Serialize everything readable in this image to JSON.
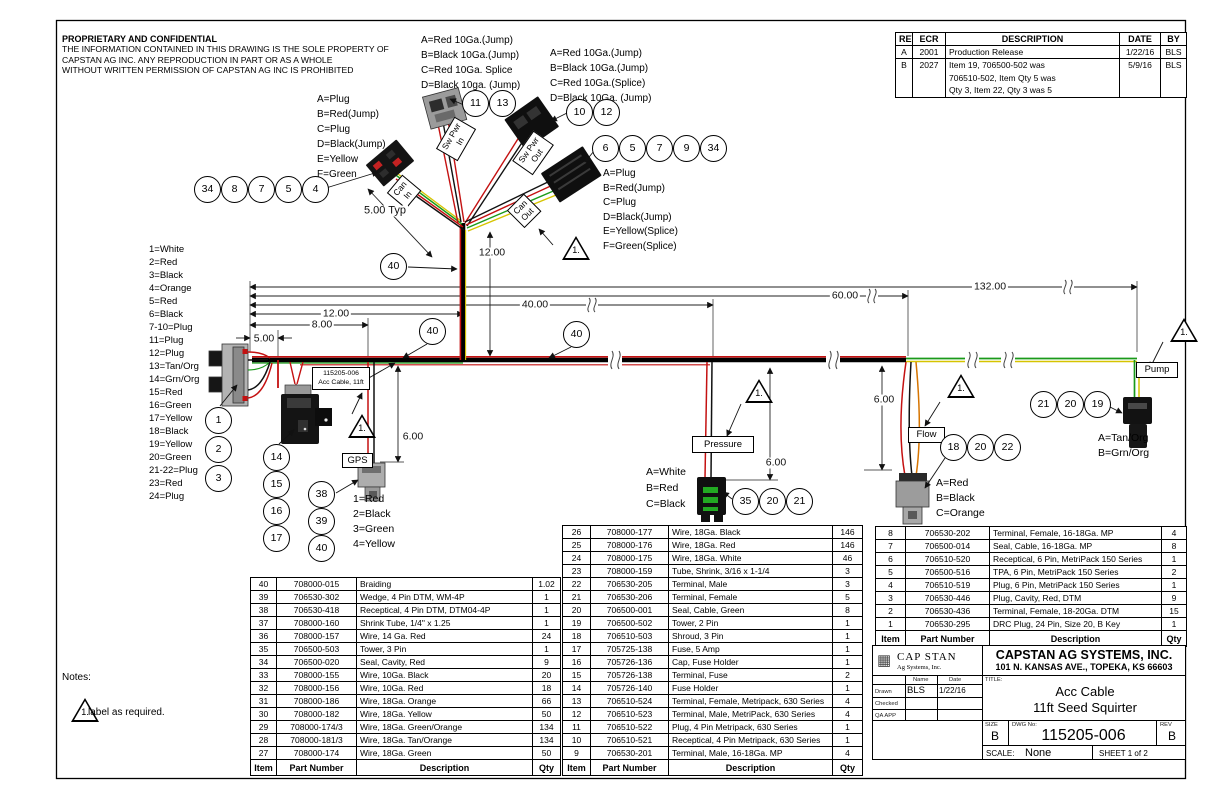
{
  "notice": {
    "title": "PROPRIETARY AND CONFIDENTIAL",
    "line1": "THE INFORMATION CONTAINED IN THIS DRAWING IS THE SOLE PROPERTY OF",
    "line2": "CAPSTAN AG INC. ANY REPRODUCTION IN PART OR AS A WHOLE",
    "line3": "WITHOUT WRITTEN PERMISSION OF CAPSTAN AG INC IS PROHIBITED"
  },
  "revision_table": {
    "headers": [
      "REV",
      "ECR",
      "DESCRIPTION",
      "DATE",
      "BY"
    ],
    "rows": [
      [
        "A",
        "2001",
        "Production Release",
        "1/22/16",
        "BLS"
      ],
      [
        "B",
        "2027",
        "Item 19, 706500-502 was\n706510-502, Item Qty 5 was\nQty 3, Item 22, Qty 3 was 5",
        "5/9/16",
        "BLS"
      ]
    ]
  },
  "wire_legend": [
    "1=White",
    "2=Red",
    "3=Black",
    "4=Orange",
    "5=Red",
    "6=Black",
    "7-10=Plug",
    "11=Plug",
    "12=Plug",
    "13=Tan/Org",
    "14=Grn/Org",
    "15=Red",
    "16=Green",
    "17=Yellow",
    "18=Black",
    "19=Yellow",
    "20=Green",
    "21-22=Plug",
    "23=Red",
    "24=Plug"
  ],
  "pin_groups": {
    "conn_a": [
      "A=Plug",
      "B=Red(Jump)",
      "C=Plug",
      "D=Black(Jump)",
      "E=Yellow",
      "F=Green"
    ],
    "jump_in": [
      "A=Red 10Ga.(Jump)",
      "B=Black 10Ga.(Jump)",
      "C=Red 10Ga. Splice",
      "D=Black 10ga. (Jump)"
    ],
    "jump_out": [
      "A=Red 10Ga.(Jump)",
      "B=Black 10Ga.(Jump)",
      "C=Red 10Ga.(Splice)",
      "D=Black 10Ga. (Jump)"
    ],
    "can_out": [
      "A=Plug",
      "B=Red(Jump)",
      "C=Plug",
      "D=Black(Jump)",
      "E=Yellow(Splice)",
      "F=Green(Splice)"
    ],
    "gps": [
      "1=Red",
      "2=Black",
      "3=Green",
      "4=Yellow"
    ],
    "pressure": [
      "A=White",
      "B=Red",
      "C=Black"
    ],
    "flow": [
      "A=Red",
      "B=Black",
      "C=Orange"
    ],
    "pump": [
      "A=Tan/Org",
      "B=Grn/Org"
    ]
  },
  "callouts": {
    "can_in": [
      "34",
      "8",
      "7",
      "5",
      "4"
    ],
    "sw_pwr_in": [
      "11",
      "13"
    ],
    "sw_pwr_out": [
      "10",
      "12"
    ],
    "can_out": [
      "6",
      "5",
      "7",
      "9",
      "34"
    ],
    "drc": [
      "1",
      "2",
      "3"
    ],
    "fuse": [
      "14",
      "15",
      "16",
      "17"
    ],
    "gps": [
      "38",
      "39",
      "40"
    ],
    "pressure": [
      "35",
      "20",
      "21"
    ],
    "flow": [
      "18",
      "20",
      "22"
    ],
    "pump": [
      "21",
      "20",
      "19"
    ],
    "braid": [
      "40",
      "40",
      "40"
    ]
  },
  "branch_labels": {
    "can_in": "Can\nIn",
    "sw_pwr_in": "Sw Pwr\nIn",
    "sw_pwr_out": "Sw Pwr\nOut",
    "can_out": "Can\nOut"
  },
  "device_labels": {
    "gps": "GPS",
    "pressure": "Pressure",
    "flow": "Flow",
    "pump": "Pump"
  },
  "cable_tag": {
    "line1": "115205-006",
    "line2": "Acc Cable, 11ft"
  },
  "dimensions": {
    "typ": "5.00 Typ",
    "trunk_v": "12.00",
    "d5": "5.00",
    "d8": "8.00",
    "d12": "12.00",
    "d40": "40.00",
    "d60": "60.00",
    "d132": "132.00",
    "gps_drop": "6.00",
    "pressure_drop": "6.00",
    "flow_drop": "6.00"
  },
  "flag": "1.",
  "notes": {
    "title": "Notes:",
    "note1": "label as required."
  },
  "bom_tables": {
    "left": {
      "headers": [
        "Item",
        "Part Number",
        "Description",
        "Qty"
      ],
      "rows": [
        [
          "40",
          "708000-015",
          "Braiding",
          "1.02"
        ],
        [
          "39",
          "706530-302",
          "Wedge, 4 Pin DTM, WM-4P",
          "1"
        ],
        [
          "38",
          "706530-418",
          "Receptical, 4 Pin DTM, DTM04-4P",
          "1"
        ],
        [
          "37",
          "708000-160",
          "Shrink Tube, 1/4\" x 1.25",
          "1"
        ],
        [
          "36",
          "708000-157",
          "Wire, 14 Ga. Red",
          "24"
        ],
        [
          "35",
          "706500-503",
          "Tower, 3 Pin",
          "1"
        ],
        [
          "34",
          "706500-020",
          "Seal, Cavity, Red",
          "9"
        ],
        [
          "33",
          "708000-155",
          "Wire, 10Ga. Black",
          "20"
        ],
        [
          "32",
          "708000-156",
          "Wire, 10Ga. Red",
          "18"
        ],
        [
          "31",
          "708000-186",
          "Wire, 18Ga. Orange",
          "66"
        ],
        [
          "30",
          "708000-182",
          "Wire, 18Ga. Yellow",
          "50"
        ],
        [
          "29",
          "708000-174/3",
          "Wire, 18Ga. Green/Orange",
          "134"
        ],
        [
          "28",
          "708000-181/3",
          "Wire, 18Ga. Tan/Orange",
          "134"
        ],
        [
          "27",
          "708000-174",
          "Wire, 18Ga. Green",
          "50"
        ]
      ]
    },
    "middle": {
      "headers": [
        "Item",
        "Part Number",
        "Description",
        "Qty"
      ],
      "rows": [
        [
          "26",
          "708000-177",
          "Wire, 18Ga. Black",
          "146"
        ],
        [
          "25",
          "708000-176",
          "Wire, 18Ga. Red",
          "146"
        ],
        [
          "24",
          "708000-175",
          "Wire, 18Ga. White",
          "46"
        ],
        [
          "23",
          "708000-159",
          "Tube, Shrink, 3/16 x 1-1/4",
          "3"
        ],
        [
          "22",
          "706530-205",
          "Terminal, Male",
          "3"
        ],
        [
          "21",
          "706530-206",
          "Terminal, Female",
          "5"
        ],
        [
          "20",
          "706500-001",
          "Seal, Cable, Green",
          "8"
        ],
        [
          "19",
          "706500-502",
          "Tower, 2 Pin",
          "1"
        ],
        [
          "18",
          "706510-503",
          "Shroud, 3 Pin",
          "1"
        ],
        [
          "17",
          "705725-138",
          "Fuse, 5 Amp",
          "1"
        ],
        [
          "16",
          "705726-136",
          "Cap, Fuse Holder",
          "1"
        ],
        [
          "15",
          "705726-138",
          "Terminal, Fuse",
          "2"
        ],
        [
          "14",
          "705726-140",
          "Fuse Holder",
          "1"
        ],
        [
          "13",
          "706510-524",
          "Terminal, Female, Metripack, 630 Series",
          "4"
        ],
        [
          "12",
          "706510-523",
          "Terminal, Male, MetriPack, 630 Series",
          "4"
        ],
        [
          "11",
          "706510-522",
          "Plug, 4 Pin Metripack, 630 Series",
          "1"
        ],
        [
          "10",
          "706510-521",
          "Receptical, 4 Pin Metripack, 630 Series",
          "1"
        ],
        [
          "9",
          "706530-201",
          "Terminal, Male, 16-18Ga. MP",
          "4"
        ]
      ]
    },
    "right": {
      "headers": [
        "Item",
        "Part Number",
        "Description",
        "Qty"
      ],
      "rows": [
        [
          "8",
          "706530-202",
          "Terminal, Female, 16-18Ga. MP",
          "4"
        ],
        [
          "7",
          "706500-014",
          "Seal, Cable, 16-18Ga. MP",
          "8"
        ],
        [
          "6",
          "706510-520",
          "Receptical, 6 Pin, MetriPack 150 Series",
          "1"
        ],
        [
          "5",
          "706500-516",
          "TPA, 6 Pin, MetriPack 150 Series",
          "2"
        ],
        [
          "4",
          "706510-519",
          "Plug, 6 Pin, MetriPack 150 Series",
          "1"
        ],
        [
          "3",
          "706530-446",
          "Plug, Cavity, Red, DTM",
          "9"
        ],
        [
          "2",
          "706530-436",
          "Terminal, Female, 18-20Ga. DTM",
          "15"
        ],
        [
          "1",
          "706530-295",
          "DRC Plug, 24 Pin, Size 20, B Key",
          "1"
        ]
      ]
    }
  },
  "title_block": {
    "logo_line1": "CAP STAN",
    "logo_line2": "Ag Systems, Inc.",
    "company": "CAPSTAN AG SYSTEMS, INC.",
    "address": "101 N. KANSAS AVE., TOPEKA, KS 66603",
    "col_name": "Name",
    "col_date": "Date",
    "drawn_label": "Drawn",
    "drawn_name": "BLS",
    "drawn_date": "1/22/16",
    "checked_label": "Checked",
    "qa_label": "QA APP",
    "title_label": "TITLE:",
    "title_line1": "Acc Cable",
    "title_line2": "11ft Seed Squirter",
    "size_label": "SIZE",
    "size": "B",
    "dwg_label": "DWG No:",
    "dwg_no": "115205-006",
    "rev_label": "REV",
    "rev": "B",
    "scale_label": "SCALE:",
    "scale": "None",
    "sheet": "SHEET 1 of 2"
  },
  "colors": {
    "wire_red": "#c41111",
    "wire_green": "#1a9a1a",
    "wire_yellow": "#d6c400",
    "wire_orange": "#d67400"
  }
}
